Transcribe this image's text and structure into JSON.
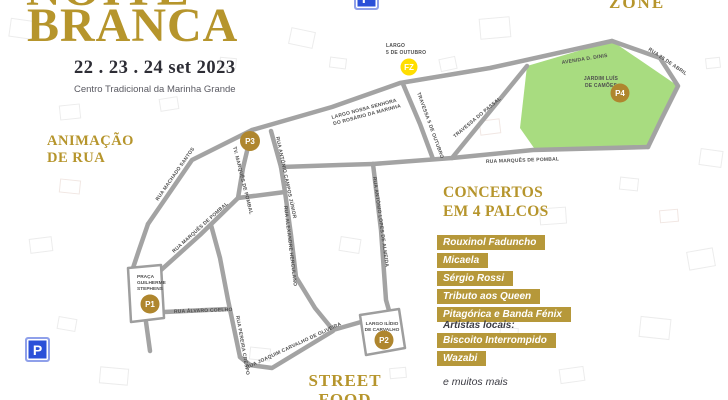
{
  "poster": {
    "title_top": "NOITE",
    "title_main": "BRANCA",
    "dates": "22 . 23 . 24 set 2023",
    "venue": "Centro Tradicional da Marinha Grande",
    "animacao_line1": "ANIMAÇÃO",
    "animacao_line2": "DE RUA",
    "zone_label": "ZONE",
    "street_food_line1": "STREET",
    "street_food_line2": "FOOD",
    "concerts": {
      "heading_line1": "CONCERTOS",
      "heading_line2": "EM 4 PALCOS",
      "acts": [
        "Rouxinol Faduncho",
        "Micaela",
        "Sérgio Rossi",
        "Tributo aos Queen",
        "Pitagórica e Banda Fénix"
      ],
      "local_heading": "Artistas locais:",
      "local_acts": [
        "Biscoito Interrompido",
        "Wazabi"
      ],
      "more": "e muitos mais"
    },
    "colors": {
      "gold": "#B6952C",
      "bar_gold": "#B6983A",
      "marker_bronze": "#AF862E",
      "fz_yellow": "#FFDE00",
      "parking_blue": "#2B50D8",
      "park_green": "#A8DC80",
      "road_gray": "#A3A3A3"
    }
  },
  "map": {
    "street_labels": [
      {
        "t1": "RUA MACHADO SANTOS"
      },
      {
        "t1": "TV. MARQUÊS DE POMBAL"
      },
      {
        "t1": "RUA MARQUÊS DE POMBAL"
      },
      {
        "t1": "RUA ANTÓNIO CAMPOS JÚNIOR"
      },
      {
        "t1": "LARGO NOSSA SENHORA",
        "t2": "DO ROSÁRIO DA MARINHA"
      },
      {
        "t1": "TRAVESSA 5 DE OUTUBRO"
      },
      {
        "t1": "AVENIDA D. DINIS"
      },
      {
        "t1": "RUA 25 DE ABRIL"
      },
      {
        "t1": "TRAVESSA DO PASSAL"
      },
      {
        "t1": "RUA MARQUÊS DE POMBAL"
      },
      {
        "t1": "RUA ANTÓNIO LOPES DE ALMEIDA"
      },
      {
        "t1": "RUA ALEXANDRE HERCULANO"
      },
      {
        "t1": "RUA PEREIRA CRESPO"
      },
      {
        "t1": "RUA JOAQUIM CARVALHO DE OLIVEIRA"
      },
      {
        "t1": "RUA ÁLVARO COELHO"
      }
    ],
    "places": {
      "largo_5_outubro": {
        "l1": "LARGO",
        "l2": "5 DE OUTUBRO"
      },
      "jardim": {
        "l1": "JARDIM LUÍS",
        "l2": "DE CAMÕES"
      },
      "praca": {
        "l1": "PRAÇA",
        "l2": "GUILHERME",
        "l3": "STEPHENS"
      },
      "largo_ilidio": {
        "l1": "LARGO ILÍDIO",
        "l2": "DE CARVALHO"
      }
    },
    "markers": {
      "p1": "P1",
      "p2": "P2",
      "p3": "P3",
      "p4": "P4",
      "fz": "FZ"
    },
    "parking_sign_label": "P"
  }
}
